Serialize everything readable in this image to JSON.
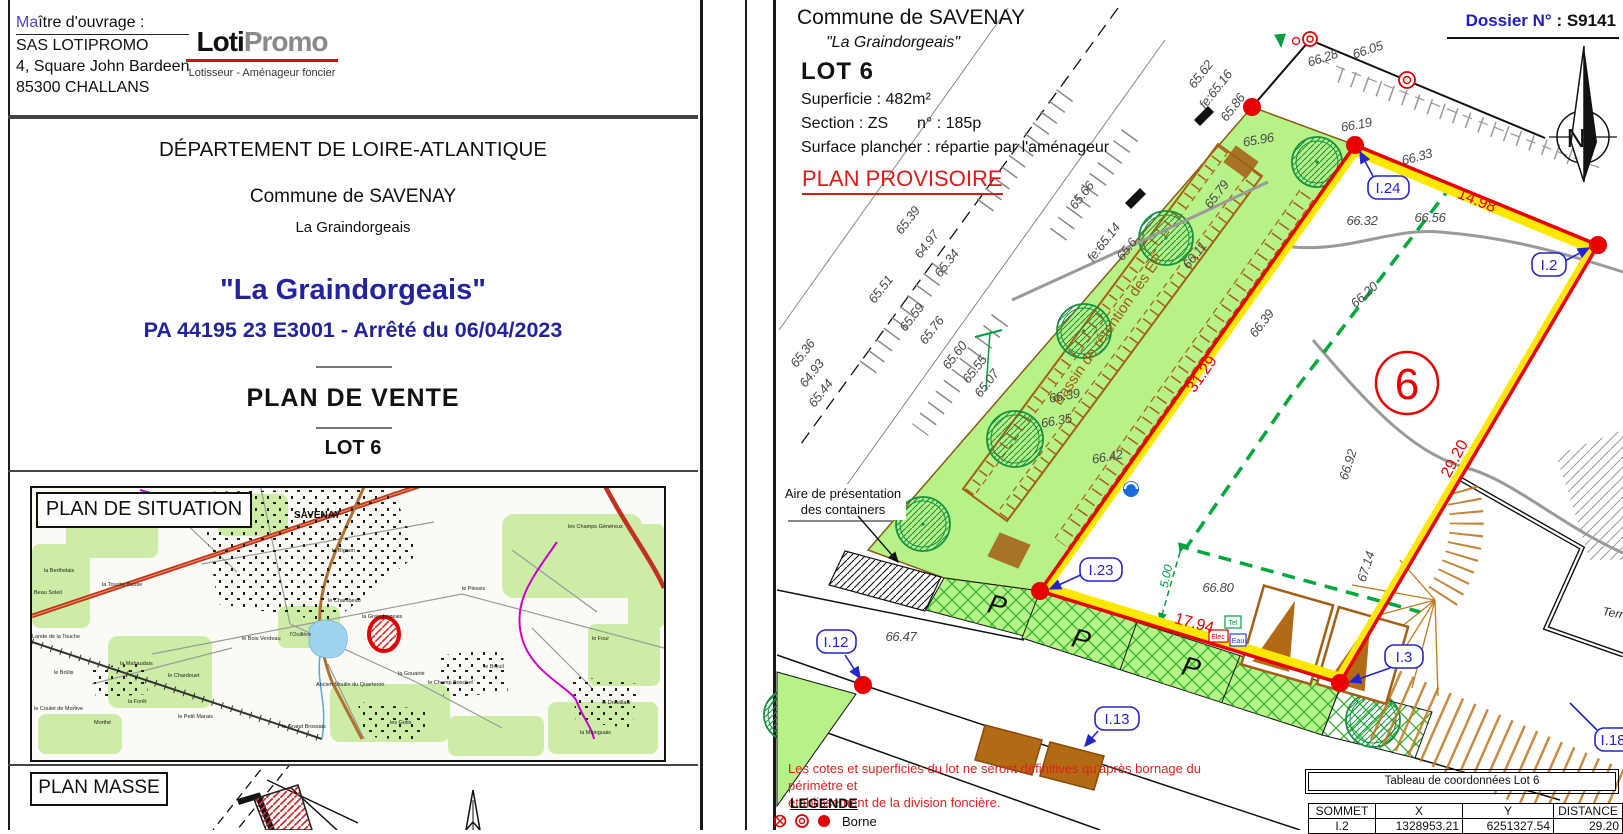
{
  "colors": {
    "navy": "#2323a0",
    "note_red": "#e02020",
    "label_blue": "#2525cc",
    "boundary_red": "#e80000",
    "boundary_yellow": "#ffe800",
    "green_area": "#b6f287",
    "logo_gray": "#8a8a8a",
    "logo_rule_red": "#cc1111"
  },
  "left_sheet": {
    "owner": {
      "label_prefix": "Ma",
      "label_rest": "ître d'ouvrage :",
      "name": "SAS LOTIPROMO",
      "address1": "4, Square John Bardeen",
      "address2": "85300 CHALLANS"
    },
    "logo": {
      "part1": "Loti",
      "part2": "Promo",
      "subtitle": "Lotisseur - Aménageur foncier"
    },
    "titles": {
      "department": "DÉPARTEMENT DE LOIRE-ATLANTIQUE",
      "commune": "Commune de SAVENAY",
      "place": "La Graindorgeais",
      "project": "\"La Graindorgeais\"",
      "permit": "PA 44195 23 E3001 - Arrêté du 06/04/2023",
      "doc": "PLAN  DE  VENTE",
      "lot": "LOT 6"
    },
    "situation": {
      "title": "PLAN  DE  SITUATION",
      "labels": [
        "SAVENAY",
        "le Bignon",
        "la Touche Basse",
        "la Graindorgeais",
        "l'Ouillère",
        "le Bois Verdeau",
        "la Gouairie",
        "le Champ Boschet",
        "le Breuil",
        "la Mainguais",
        "les Gotis",
        "le Grand Brossais",
        "le Petit Marais",
        "Morthé",
        "le Coulet de Mortive",
        "le Brûlis",
        "la Mahaudais",
        "le Chardouet",
        "la Berthelais",
        "Beau Soleil",
        "Lande de la Touche",
        "le Plessis",
        "les Champs Généreux",
        "le Four",
        "le Drouillais",
        "la Forêt",
        "Ancien Moulin du Quarteron",
        "le Chambeau"
      ]
    },
    "masse": {
      "title": "PLAN  MASSE"
    }
  },
  "right_sheet": {
    "header": {
      "commune": "Commune de SAVENAY",
      "place": "\"La Graindorgeais\"",
      "lot": "LOT 6",
      "area": "Superficie :  482m²",
      "section": "Section : ZS",
      "parcel": "n° : 185p",
      "floor": "Surface plancher : répartie par l'aménageur",
      "status": "PLAN PROVISOIRE"
    },
    "dossier": {
      "label": "Dossier N°",
      "value": " : S9141"
    },
    "compass_n": "N",
    "plan": {
      "lot_number": "6",
      "basin_label": "Bassin de rétention des EP",
      "containers_line1": "Aire de présentation",
      "containers_line2": "des containers",
      "parking_letter": "P",
      "terrain_partial": "Terr",
      "elev": [
        "65.62",
        "fe:65.16",
        "65.86",
        "65.96",
        "66.19",
        "66.28",
        "66.05",
        "66.33",
        "66.32",
        "66.56",
        "66.20",
        "65.66",
        "fe:65.14",
        "65.6",
        "66.11",
        "65.79",
        "65.39",
        "64.97",
        "65.34",
        "65.51",
        "65.59",
        "65.76",
        "65.36",
        "64.93",
        "65.44",
        "65.60",
        "65.55",
        "65.07",
        "66.39",
        "66.35",
        "66.42",
        "66.39",
        "66.92",
        "67.14",
        "66.80",
        "66.47"
      ],
      "dims_red": [
        "14.98",
        "31.29",
        "29.20",
        "17.94"
      ],
      "dim_green": "5.00",
      "vertices": [
        "I.24",
        "I.2",
        "I.23",
        "I.12",
        "I.13",
        "I.3",
        "I.18"
      ],
      "utilities": [
        "Tel",
        "Elec",
        "Eau"
      ]
    },
    "note": {
      "line1": "Les cotes et superficies du lot ne seront définitives qu'après bornage du périmètre et",
      "line2": "établissement de la division foncière."
    },
    "legend": {
      "title": "LEGENDE",
      "borne": "Borne"
    },
    "table": {
      "title": "Tableau de coordonnées Lot 6",
      "headers": [
        "SOMMET",
        "X",
        "Y",
        "DISTANCE"
      ],
      "rows": [
        [
          "I.2",
          "1328953.21",
          "6251327.54",
          "29.20"
        ]
      ]
    }
  }
}
